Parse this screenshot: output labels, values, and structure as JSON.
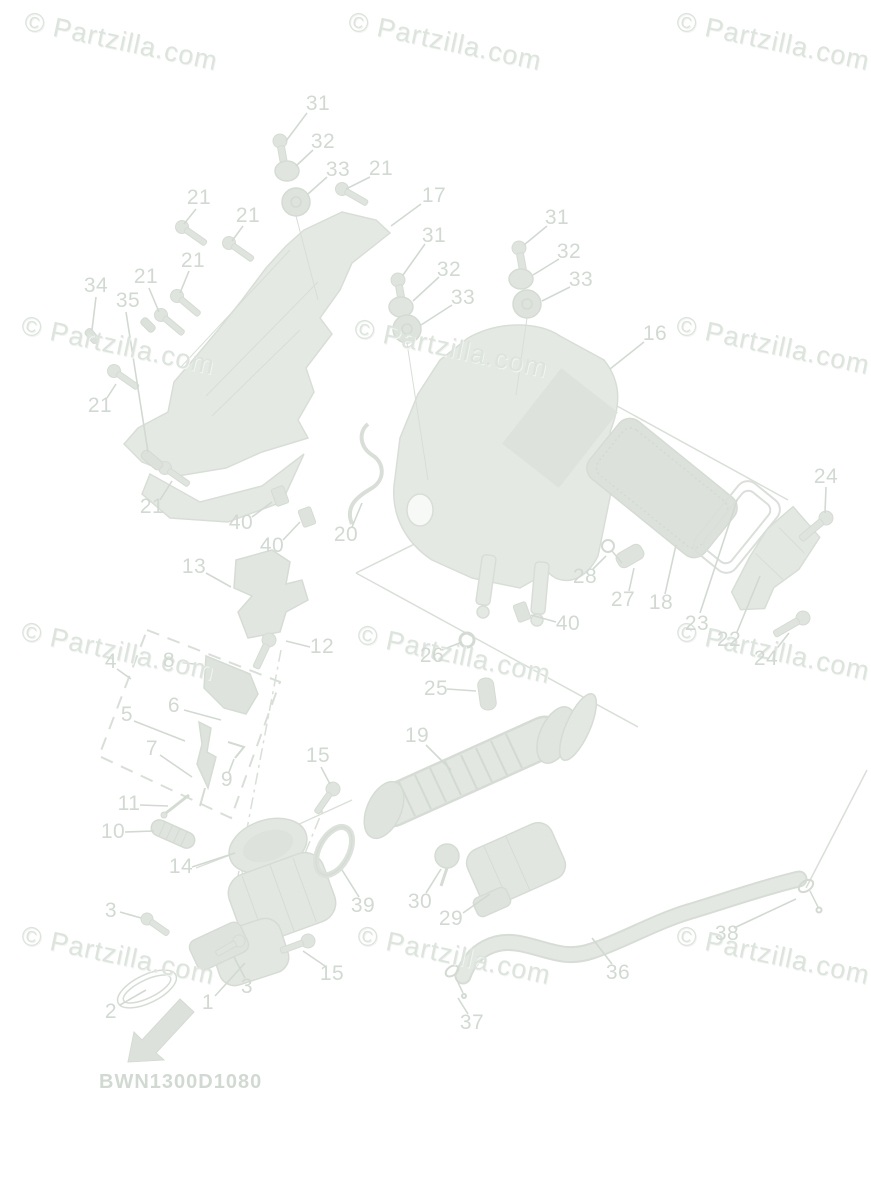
{
  "watermark": {
    "text": "© Partzilla.com",
    "rotation_deg": 12,
    "color": "#dde3dd",
    "positions": [
      [
        28,
        6
      ],
      [
        352,
        6
      ],
      [
        680,
        6
      ],
      [
        25,
        310
      ],
      [
        358,
        313
      ],
      [
        680,
        310
      ],
      [
        25,
        616
      ],
      [
        361,
        619
      ],
      [
        680,
        616
      ],
      [
        25,
        920
      ],
      [
        361,
        920
      ],
      [
        680,
        920
      ]
    ]
  },
  "diagram_code": {
    "text": "BWN1300D1080",
    "x": 99,
    "y": 1071
  },
  "colors": {
    "ink": "#d2d9d2",
    "shape_fill": "#e5e9e3",
    "shape_fill_dark": "#dde3dc",
    "shape_stroke": "#d8ded7",
    "background": "#ffffff"
  },
  "callouts": [
    {
      "t": "31",
      "x": 318,
      "y": 104,
      "l": [
        307,
        113,
        286,
        141
      ]
    },
    {
      "t": "32",
      "x": 323,
      "y": 142,
      "l": [
        313,
        150,
        296,
        166
      ]
    },
    {
      "t": "33",
      "x": 338,
      "y": 170,
      "l": [
        327,
        177,
        308,
        194
      ]
    },
    {
      "t": "21",
      "x": 381,
      "y": 169,
      "l": [
        370,
        177,
        346,
        189
      ]
    },
    {
      "t": "17",
      "x": 434,
      "y": 196,
      "l": [
        421,
        204,
        391,
        226
      ]
    },
    {
      "t": "21",
      "x": 199,
      "y": 198,
      "l": [
        196,
        209,
        184,
        224
      ]
    },
    {
      "t": "21",
      "x": 248,
      "y": 216,
      "l": [
        243,
        226,
        232,
        241
      ]
    },
    {
      "t": "21",
      "x": 193,
      "y": 261,
      "l": [
        189,
        271,
        180,
        293
      ]
    },
    {
      "t": "21",
      "x": 146,
      "y": 277,
      "l": [
        149,
        288,
        159,
        312
      ]
    },
    {
      "t": "34",
      "x": 96,
      "y": 286,
      "l": [
        96,
        297,
        92,
        330
      ]
    },
    {
      "t": "35",
      "x": 128,
      "y": 301,
      "l": [
        126,
        312,
        148,
        452
      ]
    },
    {
      "t": "21",
      "x": 100,
      "y": 406,
      "l": [
        107,
        398,
        116,
        384
      ]
    },
    {
      "t": "21",
      "x": 152,
      "y": 507,
      "l": [
        160,
        500,
        172,
        481
      ]
    },
    {
      "t": "31",
      "x": 434,
      "y": 236,
      "l": [
        425,
        244,
        403,
        275
      ]
    },
    {
      "t": "32",
      "x": 449,
      "y": 270,
      "l": [
        439,
        277,
        413,
        301
      ]
    },
    {
      "t": "33",
      "x": 463,
      "y": 298,
      "l": [
        452,
        305,
        421,
        325
      ]
    },
    {
      "t": "31",
      "x": 557,
      "y": 218,
      "l": [
        547,
        226,
        524,
        245
      ]
    },
    {
      "t": "32",
      "x": 569,
      "y": 252,
      "l": [
        559,
        259,
        533,
        275
      ]
    },
    {
      "t": "33",
      "x": 581,
      "y": 280,
      "l": [
        570,
        287,
        542,
        301
      ]
    },
    {
      "t": "16",
      "x": 655,
      "y": 334,
      "l": [
        644,
        342,
        610,
        369
      ]
    },
    {
      "t": "24",
      "x": 826,
      "y": 477,
      "l": [
        826,
        487,
        825,
        513
      ]
    },
    {
      "t": "40",
      "x": 241,
      "y": 523,
      "l": [
        252,
        517,
        272,
        502
      ]
    },
    {
      "t": "40",
      "x": 272,
      "y": 546,
      "l": [
        283,
        540,
        300,
        522
      ]
    },
    {
      "t": "20",
      "x": 346,
      "y": 535,
      "l": [
        352,
        527,
        362,
        503
      ]
    },
    {
      "t": "13",
      "x": 194,
      "y": 567,
      "l": [
        206,
        573,
        231,
        587
      ]
    },
    {
      "t": "28",
      "x": 585,
      "y": 577,
      "l": [
        593,
        569,
        606,
        556
      ]
    },
    {
      "t": "27",
      "x": 623,
      "y": 600,
      "l": [
        629,
        591,
        634,
        568
      ]
    },
    {
      "t": "18",
      "x": 661,
      "y": 603,
      "l": [
        665,
        594,
        676,
        545
      ]
    },
    {
      "t": "40",
      "x": 568,
      "y": 624,
      "l": [
        556,
        622,
        531,
        615
      ]
    },
    {
      "t": "23",
      "x": 697,
      "y": 624,
      "l": [
        700,
        613,
        737,
        500
      ]
    },
    {
      "t": "22",
      "x": 729,
      "y": 640,
      "l": [
        737,
        632,
        760,
        576
      ]
    },
    {
      "t": "24",
      "x": 766,
      "y": 659,
      "l": [
        774,
        652,
        789,
        633
      ]
    },
    {
      "t": "12",
      "x": 322,
      "y": 647,
      "l": [
        310,
        647,
        286,
        641
      ]
    },
    {
      "t": "26",
      "x": 432,
      "y": 656,
      "l": [
        442,
        650,
        462,
        642
      ]
    },
    {
      "t": "4",
      "x": 111,
      "y": 662,
      "l": [
        117,
        669,
        131,
        679
      ]
    },
    {
      "t": "8",
      "x": 169,
      "y": 661,
      "l": [
        178,
        662,
        202,
        665
      ]
    },
    {
      "t": "25",
      "x": 436,
      "y": 689,
      "l": [
        447,
        689,
        476,
        691
      ]
    },
    {
      "t": "5",
      "x": 127,
      "y": 715,
      "l": [
        134,
        721,
        185,
        741
      ]
    },
    {
      "t": "6",
      "x": 174,
      "y": 706,
      "l": [
        184,
        710,
        221,
        720
      ]
    },
    {
      "t": "7",
      "x": 152,
      "y": 749,
      "l": [
        160,
        755,
        192,
        777
      ]
    },
    {
      "t": "19",
      "x": 417,
      "y": 736,
      "l": [
        426,
        745,
        451,
        770
      ]
    },
    {
      "t": "15",
      "x": 318,
      "y": 756,
      "l": [
        321,
        767,
        330,
        784
      ]
    },
    {
      "t": "9",
      "x": 227,
      "y": 780,
      "l": [
        229,
        772,
        234,
        759
      ]
    },
    {
      "t": "11",
      "x": 129,
      "y": 804,
      "l": [
        140,
        805,
        168,
        806
      ]
    },
    {
      "t": "10",
      "x": 113,
      "y": 832,
      "l": [
        125,
        832,
        154,
        831
      ]
    },
    {
      "t": "14",
      "x": 181,
      "y": 867,
      "l": [
        192,
        867,
        235,
        853
      ]
    },
    {
      "t": "3",
      "x": 111,
      "y": 911,
      "l": [
        120,
        912,
        141,
        918
      ]
    },
    {
      "t": "39",
      "x": 363,
      "y": 906,
      "l": [
        359,
        897,
        342,
        870
      ]
    },
    {
      "t": "30",
      "x": 420,
      "y": 902,
      "l": [
        426,
        893,
        441,
        869
      ]
    },
    {
      "t": "29",
      "x": 451,
      "y": 919,
      "l": [
        463,
        913,
        490,
        894
      ]
    },
    {
      "t": "36",
      "x": 618,
      "y": 973,
      "l": [
        612,
        964,
        592,
        938
      ]
    },
    {
      "t": "37",
      "x": 472,
      "y": 1023,
      "l": [
        468,
        1014,
        458,
        998
      ]
    },
    {
      "t": "38",
      "x": 727,
      "y": 934,
      "l": [
        734,
        928,
        796,
        899
      ]
    },
    {
      "t": "15",
      "x": 332,
      "y": 974,
      "l": [
        325,
        966,
        303,
        951
      ]
    },
    {
      "t": "3",
      "x": 247,
      "y": 987,
      "l": [
        245,
        978,
        234,
        957
      ]
    },
    {
      "t": "1",
      "x": 208,
      "y": 1003,
      "l": [
        215,
        996,
        245,
        963
      ]
    },
    {
      "t": "2",
      "x": 111,
      "y": 1012,
      "l": [
        120,
        1005,
        146,
        990
      ]
    }
  ]
}
